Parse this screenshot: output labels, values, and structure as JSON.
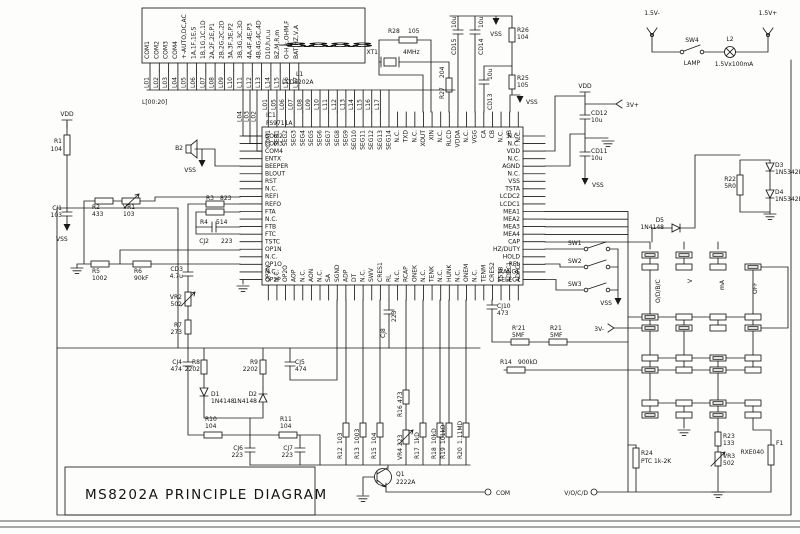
{
  "title": "MS8202A PRINCIPLE DIAGRAM",
  "lcd": {
    "display": "-8.8.8.8",
    "ref": "L1",
    "part": "LCD8202A",
    "bus_label": "L[00:20]",
    "seg_labels": [
      "COM1",
      "COM2",
      "COM3",
      "COM4",
      "+-AUTO,DC,AC",
      "1A,1F,1E,S",
      "1B,1G,1C,1D",
      "2A,2F,2E,P1",
      "2B,2G,2C,2D",
      "3A,3F,3E,P2",
      "3B,3G,3C,3D",
      "4A,4F,4E,P3",
      "4B,4G,4C,4D",
      "D10,h,n,u",
      "BZ,M,R,m",
      "O-H,k,OHM,F",
      "BAT,HZ,V,A"
    ],
    "pin_labels": [
      "L01",
      "L02",
      "L03",
      "L04",
      "L05",
      "L06",
      "L07",
      "L08",
      "L09",
      "L10",
      "L11",
      "L12",
      "L13",
      "L14",
      "L15",
      "L16",
      "L17"
    ]
  },
  "ic": {
    "ref": "IC1",
    "part": "FS9711A",
    "left_pins": [
      "COM2",
      "COM3",
      "COM4",
      "ENTX",
      "BEEPER",
      "BLOUT",
      "RST",
      "N.C.",
      "REFI",
      "REFO",
      "FTA",
      "N.C.",
      "FTB",
      "FTC",
      "TSTC",
      "OP1N",
      "N.C.",
      "OP1O",
      "N.C.",
      "OP2P"
    ],
    "right_pins": [
      "N.C.",
      "N.C.",
      "VDD",
      "N.C.",
      "AGND",
      "N.C.",
      "VSS",
      "TSTA",
      "LCDC2",
      "LCDC1",
      "MEA1",
      "MEA2",
      "MEA3",
      "MEA4",
      "CAP",
      "HZ/DUTY",
      "HOLD",
      "REL",
      "RANGE",
      "SELECT"
    ],
    "top_pins": [
      "COM1",
      "SEG1",
      "SEG2",
      "SEG3",
      "SEG4",
      "SEG5",
      "SEG6",
      "SEG7",
      "SEG8",
      "SEG9",
      "SEG10",
      "SEG11",
      "SEG12",
      "SEG13",
      "SEG14",
      "N.C.",
      "TXD",
      "N.C.",
      "XOUT",
      "XIN",
      "N.C.",
      "RLCD",
      "VDDA",
      "N.C.",
      "VGG",
      "CA",
      "CB",
      "N.C.",
      "VB",
      "N.C."
    ],
    "bottom_pins": [
      "OP2N",
      "N.C.",
      "OP2O",
      "AOP",
      "N.C.",
      "AON",
      "N.C.",
      "SA",
      "SGND",
      "ADP",
      "DT",
      "N.C.",
      "SWV",
      "CRES1",
      "RL",
      "N.C.",
      "RCAP",
      "ONEK",
      "N.C.",
      "TENK",
      "N.C.",
      "HUNK",
      "N.C.",
      "ONEM",
      "N.C.",
      "TENM",
      "CRES2",
      "TSTB",
      "ADPC1",
      "ADPC2"
    ],
    "com_wire_labels": [
      "L04",
      "L03",
      "L02"
    ],
    "top_wire_labels": [
      "L01",
      "L05",
      "L06",
      "L07",
      "L08",
      "L09",
      "L10",
      "L11",
      "L12",
      "L13",
      "L14",
      "L15",
      "L16",
      "L17"
    ]
  },
  "nets": {
    "vdd": "VDD",
    "vss": "VSS",
    "v3plus": "3V+",
    "v3minus": "3V-"
  },
  "battery": {
    "neg": "1.5V-",
    "pos": "1.5V+",
    "sw_ref": "SW4",
    "sw_label": "LAMP",
    "lamp_ref": "L2",
    "lamp_spec": "1.5Vx100mA"
  },
  "switches": {
    "sw1": "SW1",
    "sw2": "SW2",
    "sw3": "SW3"
  },
  "rotary": {
    "pos1": "O/D/B/C",
    "pos2": "V",
    "pos3": "mA",
    "pos4": "OFF"
  },
  "terminals": {
    "com": "COM",
    "vocd": "V/O/C/D"
  },
  "parts": {
    "r1": {
      "ref": "R1",
      "value": "104"
    },
    "cj1": {
      "ref": "CJ1",
      "value": "103"
    },
    "r2": {
      "ref": "R2",
      "value": "433"
    },
    "vr1": {
      "ref": "VR1",
      "value": "103"
    },
    "b2": {
      "ref": "B2",
      "value": ""
    },
    "r3": {
      "ref": "R3",
      "value": "823"
    },
    "r4": {
      "ref": "R4",
      "value": "514"
    },
    "cj2": {
      "ref": "CJ2",
      "value": "223"
    },
    "r5": {
      "ref": "R5",
      "value": "1002"
    },
    "r6": {
      "ref": "R6",
      "value": "90kF"
    },
    "cd3": {
      "ref": "CD3",
      "value": "4.7u"
    },
    "vr2": {
      "ref": "VR2",
      "value": "502"
    },
    "r7": {
      "ref": "R7",
      "value": "273"
    },
    "cj4": {
      "ref": "CJ4",
      "value": "474"
    },
    "r8": {
      "ref": "R8",
      "value": "2202"
    },
    "r9": {
      "ref": "R9",
      "value": "2202"
    },
    "cj5": {
      "ref": "CJ5",
      "value": "474"
    },
    "d1": {
      "ref": "D1",
      "value": "1N4148"
    },
    "d2": {
      "ref": "D2",
      "value": "1N4148"
    },
    "r10": {
      "ref": "R10",
      "value": "104"
    },
    "r11": {
      "ref": "R11",
      "value": "104"
    },
    "cj6": {
      "ref": "CJ6",
      "value": "223"
    },
    "cj7": {
      "ref": "CJ7",
      "value": "223"
    },
    "cj8": {
      "ref": "CJ8",
      "value": "223"
    },
    "cj10": {
      "ref": "CJ10",
      "value": "473"
    },
    "r12": {
      "ref": "R12",
      "value": "103"
    },
    "r13": {
      "ref": "R13",
      "value": "1003"
    },
    "r15": {
      "ref": "R15",
      "value": "104"
    },
    "r16": {
      "ref": "R16",
      "value": "473"
    },
    "vr4": {
      "ref": "VR4",
      "value": "223"
    },
    "r17": {
      "ref": "R17",
      "value": "1kD"
    },
    "r18": {
      "ref": "R18",
      "value": "10kD"
    },
    "r19": {
      "ref": "R19",
      "value": "101kD"
    },
    "r20": {
      "ref": "R20",
      "value": "1.11MD"
    },
    "r21p": {
      "ref": "R'21",
      "value": "5MF"
    },
    "r21": {
      "ref": "R21",
      "value": "5MF"
    },
    "r14": {
      "ref": "R14",
      "value": "900kD"
    },
    "r28": {
      "ref": "R28",
      "value": "105"
    },
    "xt1": {
      "ref": "XT1",
      "value": "4MHz"
    },
    "r27": {
      "ref": "R27",
      "value": "204"
    },
    "cd15": {
      "ref": "CD15",
      "value": "10u"
    },
    "cd14": {
      "ref": "CD14",
      "value": "10u"
    },
    "cd13": {
      "ref": "CD13",
      "value": "10u"
    },
    "r26": {
      "ref": "R26",
      "value": "104"
    },
    "r25": {
      "ref": "R25",
      "value": "105"
    },
    "cd12": {
      "ref": "CD12",
      "value": "10u"
    },
    "cd11": {
      "ref": "CD11",
      "value": "10u"
    },
    "r22": {
      "ref": "R22",
      "value": "5R0"
    },
    "d3": {
      "ref": "D3",
      "value": "1N5342B"
    },
    "d4": {
      "ref": "D4",
      "value": "1N5342B"
    },
    "d5": {
      "ref": "D5",
      "value": "1N4148"
    },
    "r23": {
      "ref": "R23",
      "value": "133"
    },
    "vr3": {
      "ref": "VR3",
      "value": "502"
    },
    "r24": {
      "ref": "R24",
      "value": "PTC 1k-2K"
    },
    "f1": {
      "ref": "F1",
      "value": "RXE040"
    },
    "q1": {
      "ref": "Q1",
      "value": "2222A"
    }
  }
}
